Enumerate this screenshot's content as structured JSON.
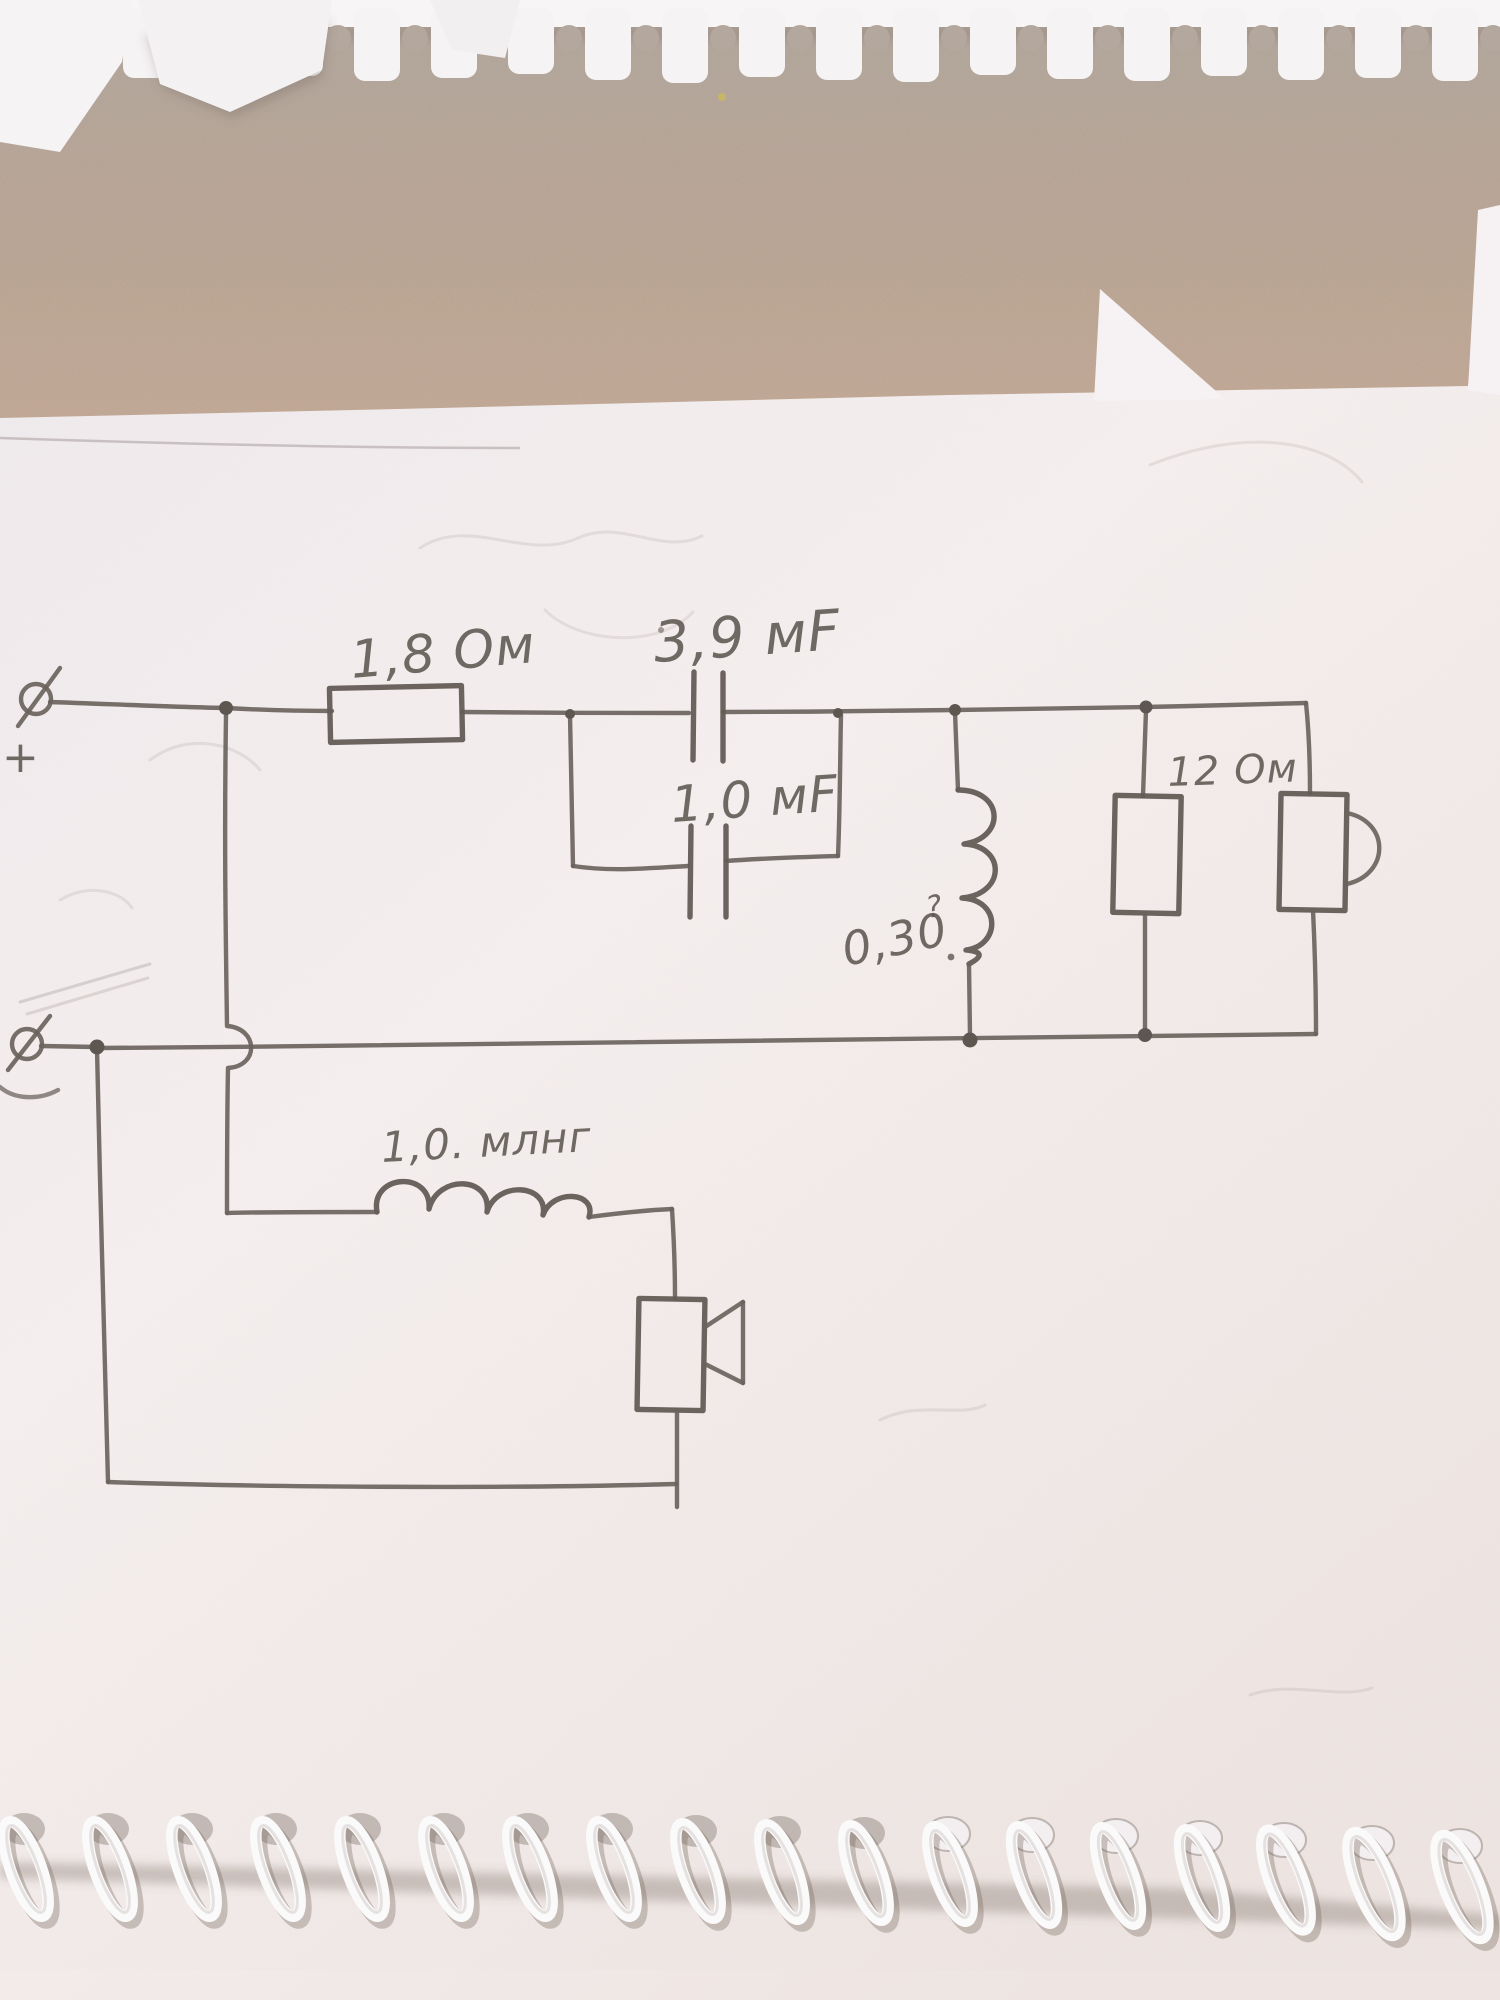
{
  "scene": {
    "description": "Photograph of a spiral-bound notebook page with a hand-drawn pencil schematic of a two-way loudspeaker crossover network",
    "medium": "pencil on white notebook paper",
    "background": "textured beige fabric surface"
  },
  "colors": {
    "pencil": "#6a635d",
    "paper": "#f3edee",
    "cloth_top": "#b3a79d",
    "cloth_warm": "#c5a992",
    "spiral_plastic": "#fbfafa"
  },
  "labels": {
    "series_resistor": "1,8 Ом",
    "capacitor_top": "3,9 мF",
    "capacitor_bottom": "1,0 мF",
    "shunt_inductor_value": "0,30",
    "shunt_inductor_question": "?",
    "shunt_resistor": "12 Ом",
    "series_inductor": "1,0. млнг",
    "plus_terminal": "+"
  },
  "circuit": {
    "input_terminals": [
      {
        "id": "top-terminal",
        "symbol": "circle-with-slash",
        "polarity_mark": "+"
      },
      {
        "id": "bottom-terminal",
        "symbol": "circle-with-slash",
        "polarity_mark": ""
      }
    ],
    "components": [
      {
        "id": "series-resistor",
        "type": "resistor",
        "value": "1,8 Ом",
        "orientation": "horizontal",
        "branch": "tweeter high-pass, series"
      },
      {
        "id": "capacitor-a",
        "type": "capacitor",
        "value": "3,9 мF",
        "orientation": "vertical plates on horizontal wire",
        "branch": "series, paralleled with capacitor-b"
      },
      {
        "id": "capacitor-b",
        "type": "capacitor",
        "value": "1,0 мF",
        "orientation": "vertical plates on horizontal wire",
        "branch": "parallel loop under capacitor-a"
      },
      {
        "id": "shunt-inductor",
        "type": "inductor",
        "value": "0,30",
        "annotation": "?",
        "orientation": "vertical coil, bumps facing right",
        "branch": "shunt to bottom rail"
      },
      {
        "id": "shunt-resistor",
        "type": "resistor",
        "value": "12 Ом",
        "orientation": "vertical",
        "branch": "shunt to bottom rail"
      },
      {
        "id": "tweeter-speaker",
        "type": "speaker",
        "orientation": "vertical box with horn arc to the right",
        "branch": "rightmost shunt"
      },
      {
        "id": "series-inductor",
        "type": "inductor",
        "value": "1,0. млнг",
        "orientation": "horizontal coil, bumps facing up",
        "branch": "woofer low-pass, series"
      },
      {
        "id": "woofer-speaker",
        "type": "speaker",
        "orientation": "vertical box with horn to the right",
        "branch": "lower loop"
      }
    ],
    "topology_notes": "Top rail feeds R 1.8Ω then paralleled caps 3.9µF/1.0µF, then three parallel shunt branches (0.30 inductor, 12Ω resistor, speaker). Lower loop: wire from first top node hops over the bottom rail, passes 1.0 mH coil into second speaker and returns to bottom terminal."
  },
  "notebook": {
    "top_edge": "torn perforation strip with keyhole-shaped punch holes",
    "bottom_edge": "white plastic spiral coil binding over punched holes",
    "loose_scraps": "small torn white paper pieces at upper left and upper right"
  }
}
